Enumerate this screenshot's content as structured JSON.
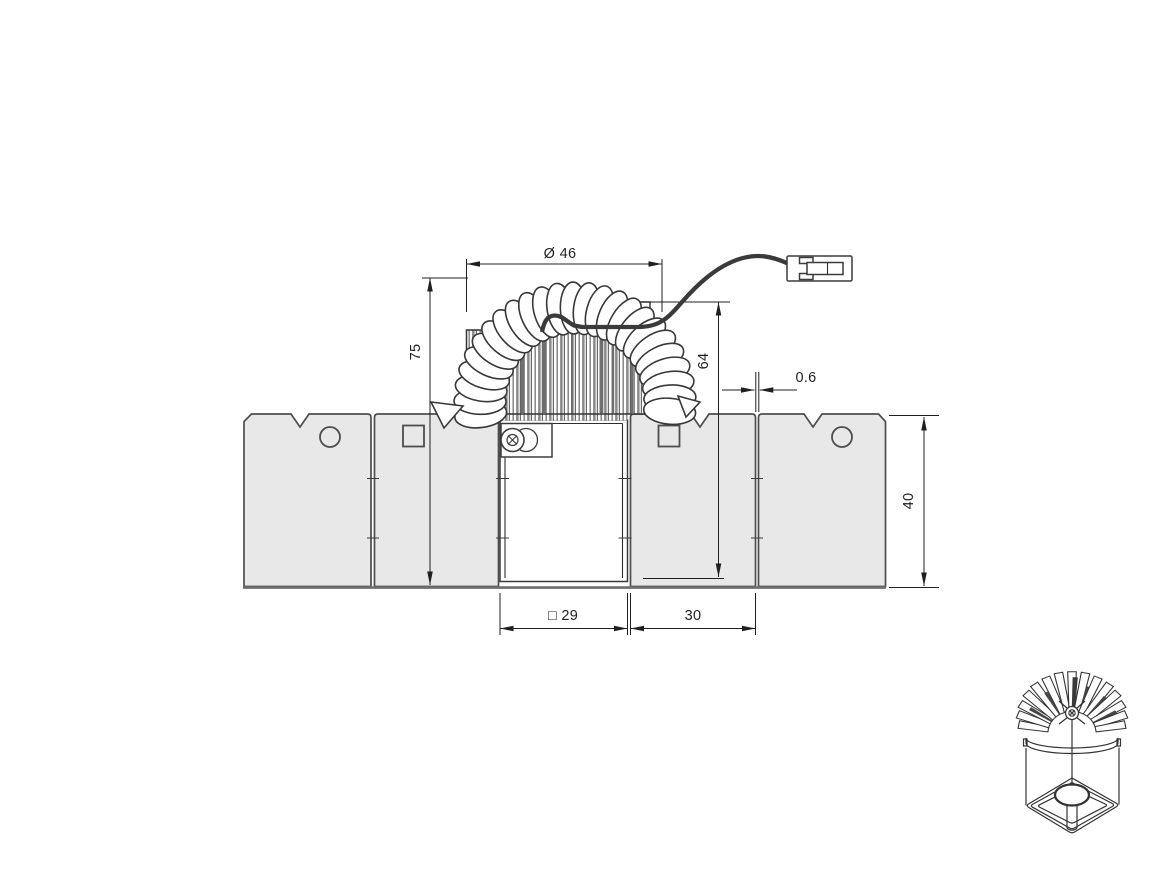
{
  "page": {
    "background": "#ffffff"
  },
  "drawing": {
    "type": "technical-dimension-drawing",
    "line_color": "#1f1f1f",
    "panel_fill": "#e8e8e8",
    "panel_stroke": "#4d4d4d",
    "cable_color": "#3a3a3a",
    "dimensions": {
      "diameter_top": "Ø 46",
      "overall_height": "75",
      "recessed_height": "64",
      "panel_gap": "0.6",
      "panel_thickness": "40",
      "cutout_square": "□ 29",
      "panel_width": "30"
    },
    "symbols": {
      "panel_a": "circle",
      "panel_b": "square",
      "panel_c": "square",
      "panel_d": "circle"
    }
  }
}
